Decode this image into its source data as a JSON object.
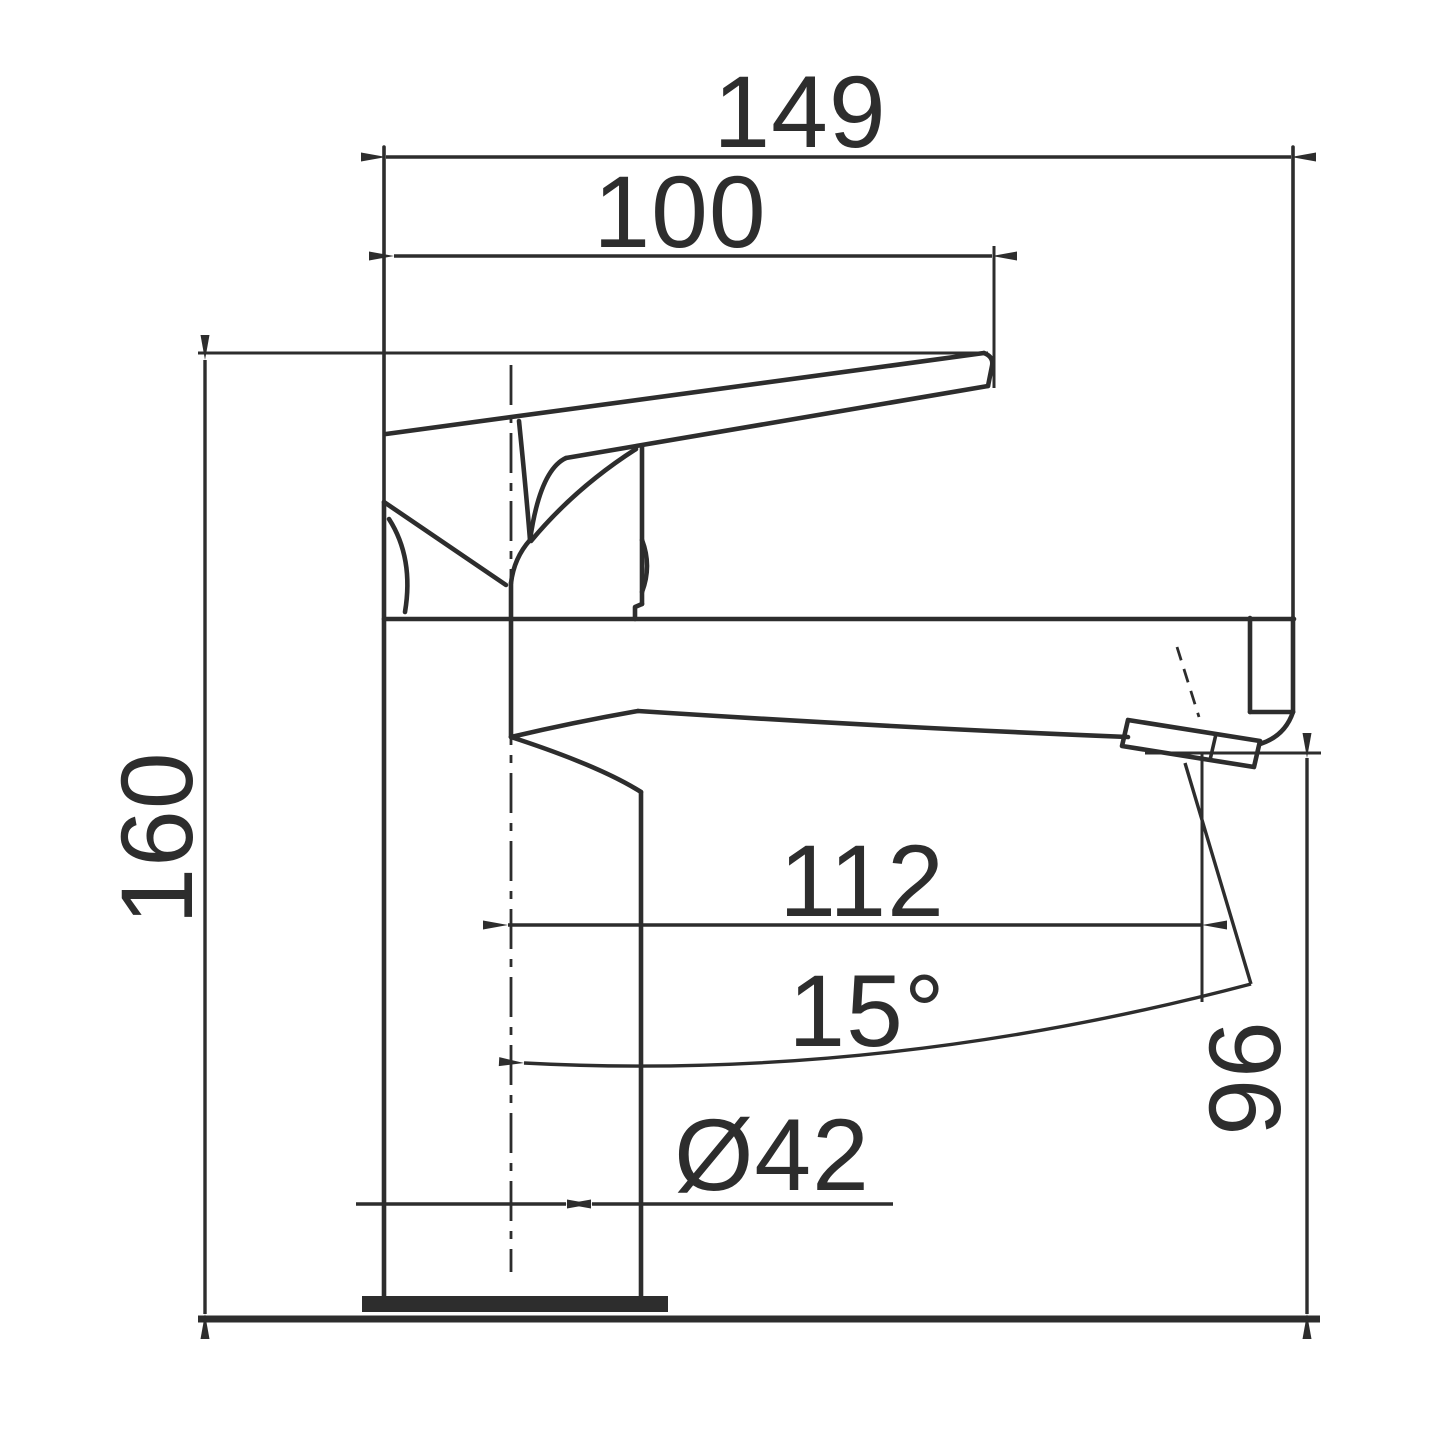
{
  "drawing": {
    "kind": "technical dimension drawing",
    "subject": "single-lever basin mixer tap, side elevation with dimension lines",
    "colors": {
      "line": "#2d2d2d",
      "background": "#ffffff"
    },
    "labels": {
      "total_length": "149",
      "handle_length": "100",
      "overall_height": "160",
      "spout_reach": "112",
      "spout_angle": "15°",
      "spout_outlet_height": "96",
      "body_diameter": "Ø42"
    },
    "dimension_values_mm": {
      "total_length": 149,
      "handle_length": 100,
      "overall_height": 160,
      "spout_reach": 112,
      "spout_angle_deg": 15,
      "spout_outlet_height": 96,
      "body_diameter": 42
    }
  }
}
